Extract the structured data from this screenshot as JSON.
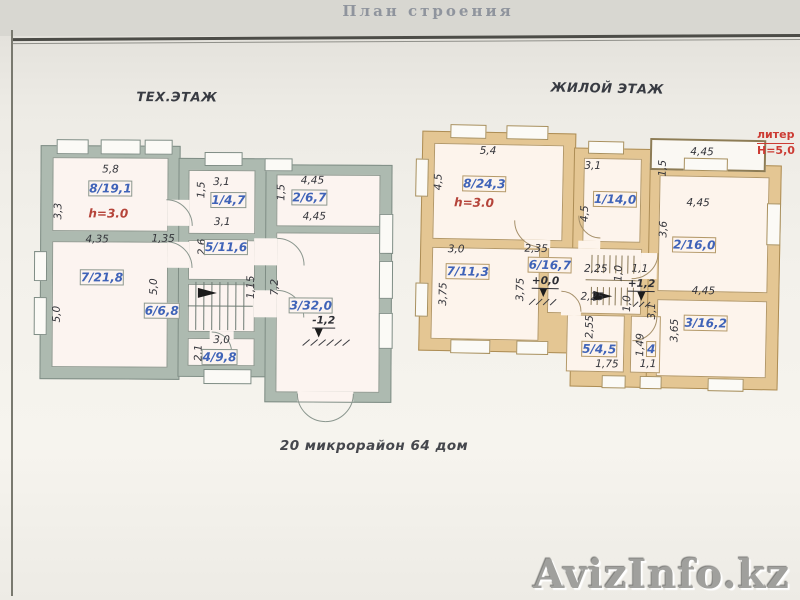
{
  "photo": {
    "header_title": "План строения",
    "footer_address": "20 микрорайон  64 дом",
    "watermark": "AvizInfo.kz",
    "side_note": {
      "line1": "литер",
      "line2": "Н=5,0"
    }
  },
  "colors": {
    "tech_wall": "#adbab0",
    "res_wall": "#e4c693",
    "room_fill": "#fcf4f0",
    "room_label_blue": "#3f63b8",
    "height_label_red": "#b5443a",
    "dim_label": "#33343a",
    "side_note_red": "#cc3b33",
    "watermark_gray": "#a0a09d"
  },
  "plans": [
    {
      "id": "tech",
      "title": "ТЕХ.ЭТАЖ",
      "title_x": 176,
      "title_y": 98,
      "labels": [
        {
          "text": "5,8",
          "x": 110,
          "y": 170,
          "kind": "dim"
        },
        {
          "text": "8/19,1",
          "x": 110,
          "y": 189,
          "kind": "room"
        },
        {
          "text": "h=3.0",
          "x": 108,
          "y": 214,
          "kind": "red"
        },
        {
          "text": "3,3",
          "x": 58,
          "y": 212,
          "kind": "dim",
          "rot": 1
        },
        {
          "text": "4,35",
          "x": 97,
          "y": 240,
          "kind": "dim"
        },
        {
          "text": "1,35",
          "x": 163,
          "y": 239,
          "kind": "dim"
        },
        {
          "text": "7/21,8",
          "x": 102,
          "y": 278,
          "kind": "room"
        },
        {
          "text": "5,0",
          "x": 57,
          "y": 315,
          "kind": "dim",
          "rot": 1
        },
        {
          "text": "5,0",
          "x": 154,
          "y": 287,
          "kind": "dim",
          "rot": 1
        },
        {
          "text": "6/6,8",
          "x": 162,
          "y": 311,
          "kind": "room"
        },
        {
          "text": "1,5",
          "x": 201,
          "y": 190,
          "kind": "dim",
          "rot": 1
        },
        {
          "text": "3,1",
          "x": 221,
          "y": 182,
          "kind": "dim"
        },
        {
          "text": "1/4,7",
          "x": 228,
          "y": 200,
          "kind": "room"
        },
        {
          "text": "3,1",
          "x": 222,
          "y": 222,
          "kind": "dim"
        },
        {
          "text": "2,6",
          "x": 202,
          "y": 247,
          "kind": "dim",
          "rot": 1
        },
        {
          "text": "5/11,6",
          "x": 226,
          "y": 247,
          "kind": "room"
        },
        {
          "text": "1,15",
          "x": 251,
          "y": 287,
          "kind": "dim",
          "rot": 1
        },
        {
          "text": "3,0",
          "x": 222,
          "y": 340,
          "kind": "dim"
        },
        {
          "text": "2,1",
          "x": 199,
          "y": 353,
          "kind": "dim",
          "rot": 1
        },
        {
          "text": "4/9,8",
          "x": 220,
          "y": 357,
          "kind": "room"
        },
        {
          "text": "1,5",
          "x": 281,
          "y": 192,
          "kind": "dim",
          "rot": 1
        },
        {
          "text": "4,45",
          "x": 312,
          "y": 180,
          "kind": "dim"
        },
        {
          "text": "2/6,7",
          "x": 309,
          "y": 197,
          "kind": "room"
        },
        {
          "text": "4,45",
          "x": 314,
          "y": 216,
          "kind": "dim"
        },
        {
          "text": "7,2",
          "x": 275,
          "y": 287,
          "kind": "dim",
          "rot": 1
        },
        {
          "text": "3/32,0",
          "x": 311,
          "y": 305,
          "kind": "room"
        },
        {
          "text": "-1,2",
          "x": 324,
          "y": 321,
          "kind": "level"
        }
      ]
    },
    {
      "id": "res",
      "title": "ЖИЛОЙ ЭТАЖ",
      "title_x": 604,
      "title_y": 89,
      "labels": [
        {
          "text": "5,4",
          "x": 486,
          "y": 153,
          "kind": "dim"
        },
        {
          "text": "4,5",
          "x": 437,
          "y": 185,
          "kind": "dim",
          "rot": 1
        },
        {
          "text": "8/24,3",
          "x": 483,
          "y": 186,
          "kind": "room"
        },
        {
          "text": "h=3.0",
          "x": 473,
          "y": 205,
          "kind": "red"
        },
        {
          "text": "3,1",
          "x": 591,
          "y": 166,
          "kind": "dim"
        },
        {
          "text": "4,5",
          "x": 584,
          "y": 214,
          "kind": "dim",
          "rot": 1
        },
        {
          "text": "1/14,0",
          "x": 614,
          "y": 199,
          "kind": "room"
        },
        {
          "text": "4,45",
          "x": 700,
          "y": 150,
          "kind": "dim"
        },
        {
          "text": "1,5",
          "x": 661,
          "y": 167,
          "kind": "dim",
          "rot": 1
        },
        {
          "text": "4,45",
          "x": 697,
          "y": 201,
          "kind": "dim"
        },
        {
          "text": "3,6",
          "x": 663,
          "y": 228,
          "kind": "dim",
          "rot": 1
        },
        {
          "text": "2/16,0",
          "x": 694,
          "y": 243,
          "kind": "room"
        },
        {
          "text": "4,45",
          "x": 704,
          "y": 289,
          "kind": "dim"
        },
        {
          "text": "3,65",
          "x": 676,
          "y": 329,
          "kind": "dim",
          "rot": 1
        },
        {
          "text": "3/16,2",
          "x": 707,
          "y": 321,
          "kind": "room"
        },
        {
          "text": "3,0",
          "x": 456,
          "y": 252,
          "kind": "dim"
        },
        {
          "text": "7/11,3",
          "x": 468,
          "y": 274,
          "kind": "room"
        },
        {
          "text": "3,75",
          "x": 444,
          "y": 297,
          "kind": "dim",
          "rot": 1
        },
        {
          "text": "3,75",
          "x": 521,
          "y": 291,
          "kind": "dim",
          "rot": 1
        },
        {
          "text": "2,35",
          "x": 536,
          "y": 250,
          "kind": "dim"
        },
        {
          "text": "6/16,7",
          "x": 550,
          "y": 266,
          "kind": "room"
        },
        {
          "text": "+0,0",
          "x": 546,
          "y": 283,
          "kind": "level"
        },
        {
          "text": "2,25",
          "x": 596,
          "y": 269,
          "kind": "dim"
        },
        {
          "text": "1,0",
          "x": 619,
          "y": 273,
          "kind": "dim",
          "rot": 1
        },
        {
          "text": "1,1",
          "x": 640,
          "y": 268,
          "kind": "dim"
        },
        {
          "text": "+1,2",
          "x": 642,
          "y": 284,
          "kind": "level"
        },
        {
          "text": "2,25",
          "x": 593,
          "y": 297,
          "kind": "dim"
        },
        {
          "text": "1,0",
          "x": 628,
          "y": 303,
          "kind": "dim",
          "rot": 1
        },
        {
          "text": "3,1",
          "x": 653,
          "y": 310,
          "kind": "dim",
          "rot": 1
        },
        {
          "text": "2,55",
          "x": 591,
          "y": 327,
          "kind": "dim",
          "rot": 1
        },
        {
          "text": "5/4,5",
          "x": 601,
          "y": 349,
          "kind": "room"
        },
        {
          "text": "1,75",
          "x": 609,
          "y": 364,
          "kind": "dim"
        },
        {
          "text": "1,49",
          "x": 642,
          "y": 344,
          "kind": "dim",
          "rot": 1
        },
        {
          "text": "4",
          "x": 653,
          "y": 348,
          "kind": "room"
        },
        {
          "text": "1,1",
          "x": 650,
          "y": 363,
          "kind": "dim"
        }
      ]
    }
  ]
}
